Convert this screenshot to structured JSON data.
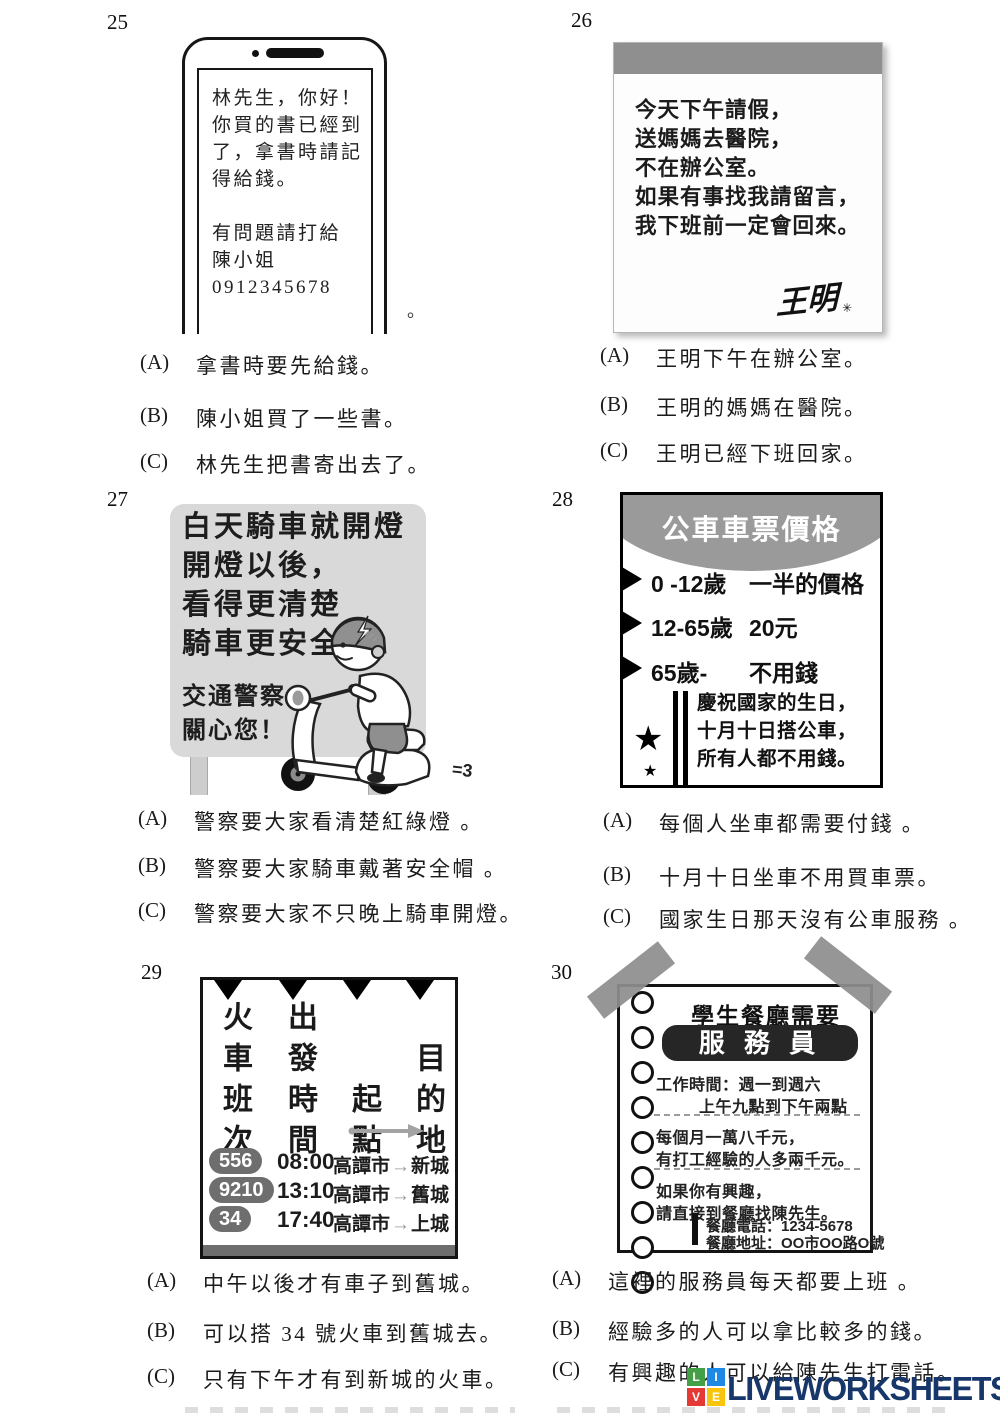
{
  "questions": {
    "q25": {
      "number": "25",
      "message_lines_1": [
        "林先生，你好！",
        "你買的書已經到",
        "了，拿書時請記",
        "得給錢。"
      ],
      "message_lines_2": [
        "有問題請打給",
        "陳小姐",
        "0912345678"
      ],
      "stray_period": "。",
      "options": [
        {
          "label": "(A)",
          "text": "拿書時要先給錢。"
        },
        {
          "label": "(B)",
          "text": "陳小姐買了一些書。"
        },
        {
          "label": "(C)",
          "text": "林先生把書寄出去了。"
        }
      ]
    },
    "q26": {
      "number": "26",
      "note_lines": [
        "今天下午請假，",
        "送媽媽去醫院，",
        "不在辦公室。",
        "如果有事找我請留言，",
        "我下班前一定會回來。"
      ],
      "signature": "王明",
      "signature_mark": "✳",
      "options": [
        {
          "label": "(A)",
          "text": "王明下午在辦公室。"
        },
        {
          "label": "(B)",
          "text": "王明的媽媽在醫院。"
        },
        {
          "label": "(C)",
          "text": "王明已經下班回家。"
        }
      ]
    },
    "q27": {
      "number": "27",
      "sign_lines": [
        "白天騎車就開燈",
        "開燈以後，",
        "看得更清楚",
        "騎車更安全"
      ],
      "footer_lines": [
        "交通警察",
        "關心您！"
      ],
      "exhaust": "=3",
      "options": [
        {
          "label": "(A)",
          "text": "警察要大家看清楚紅綠燈 。"
        },
        {
          "label": "(B)",
          "text": "警察要大家騎車戴著安全帽 。"
        },
        {
          "label": "(C)",
          "text": "警察要大家不只晚上騎車開燈。"
        }
      ]
    },
    "q28": {
      "number": "28",
      "title": "公車車票價格",
      "fares": [
        {
          "age": "0 -12歲",
          "price": "一半的價格"
        },
        {
          "age": "12-65歲",
          "price": "20元"
        },
        {
          "age": "65歲-",
          "price": "不用錢"
        }
      ],
      "star_icon": "★",
      "promo_lines": [
        "慶祝國家的生日，",
        "十月十日搭公車，",
        "所有人都不用錢。"
      ],
      "options": [
        {
          "label": "(A)",
          "text": "每個人坐車都需要付錢 。"
        },
        {
          "label": "(B)",
          "text": "十月十日坐車不用買車票。"
        },
        {
          "label": "(C)",
          "text": "國家生日那天沒有公車服務 。"
        }
      ]
    },
    "q29": {
      "number": "29",
      "headers": [
        "火車班次",
        "出發時間",
        "起點",
        "目的地"
      ],
      "route_arrow": "→",
      "rows": [
        {
          "train": "556",
          "time": "08:00",
          "from": "高譚市",
          "to": "新城"
        },
        {
          "train": "9210",
          "time": "13:10",
          "from": "高譚市",
          "to": "舊城"
        },
        {
          "train": "34",
          "time": "17:40",
          "from": "高譚市",
          "to": "上城"
        }
      ],
      "options": [
        {
          "label": "(A)",
          "text": "中午以後才有車子到舊城。"
        },
        {
          "label": "(B)",
          "text": "可以搭 34 號火車到舊城去。"
        },
        {
          "label": "(C)",
          "text": "只有下午才有到新城的火車。"
        }
      ]
    },
    "q30": {
      "number": "30",
      "title": "學生餐廳需要",
      "role": "服 務 員",
      "work_line1": "工作時間：週一到週六",
      "work_line2": "上午九點到下午兩點",
      "salary_line1": "每個月一萬八千元，",
      "salary_line2": "有打工經驗的人多兩千元。",
      "interest_line1": "如果你有興趣，",
      "interest_line2": "請直接到餐廳找陳先生。",
      "phone": "餐廳電話：1234-5678",
      "address": "餐廳地址：OO市OO路O號",
      "options": [
        {
          "label": "(A)",
          "text": "這裡的服務員每天都要上班 。"
        },
        {
          "label": "(B)",
          "text": "經驗多的人可以拿比較多的錢。"
        },
        {
          "label": "(C)",
          "text": "有興趣的人可以給陳先生打電話。"
        }
      ]
    }
  },
  "watermark": {
    "text": "LIVEWORKSHEETS",
    "color": "#17376a",
    "squares": [
      {
        "letter": "L",
        "color": "#43a047"
      },
      {
        "letter": "I",
        "color": "#1e88e5"
      },
      {
        "letter": "V",
        "color": "#e53935"
      },
      {
        "letter": "E",
        "color": "#f6c50c"
      }
    ]
  }
}
